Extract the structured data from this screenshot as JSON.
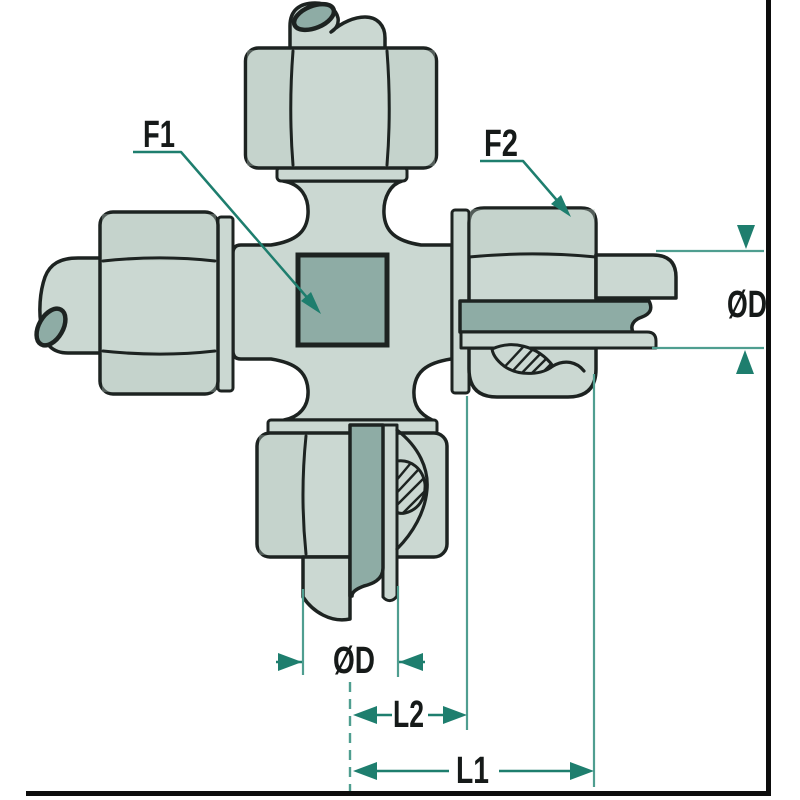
{
  "diagram": {
    "kind": "cross-compression-fitting-cutaway",
    "labels": {
      "f1": "F1",
      "f2": "F2",
      "diameter": "ØD",
      "length1": "L1",
      "length2": "L2"
    },
    "colors": {
      "background": "#ffffff",
      "body-fill": "#cbd8d2",
      "body-shade": "#b9cac3",
      "section-fill": "#8eaca5",
      "outline": "#1d2321",
      "dim-line": "#1e7e6e",
      "ext-line": "#4f9e90",
      "frame": "#0d0d0d",
      "label-color": "#161a19"
    }
  }
}
